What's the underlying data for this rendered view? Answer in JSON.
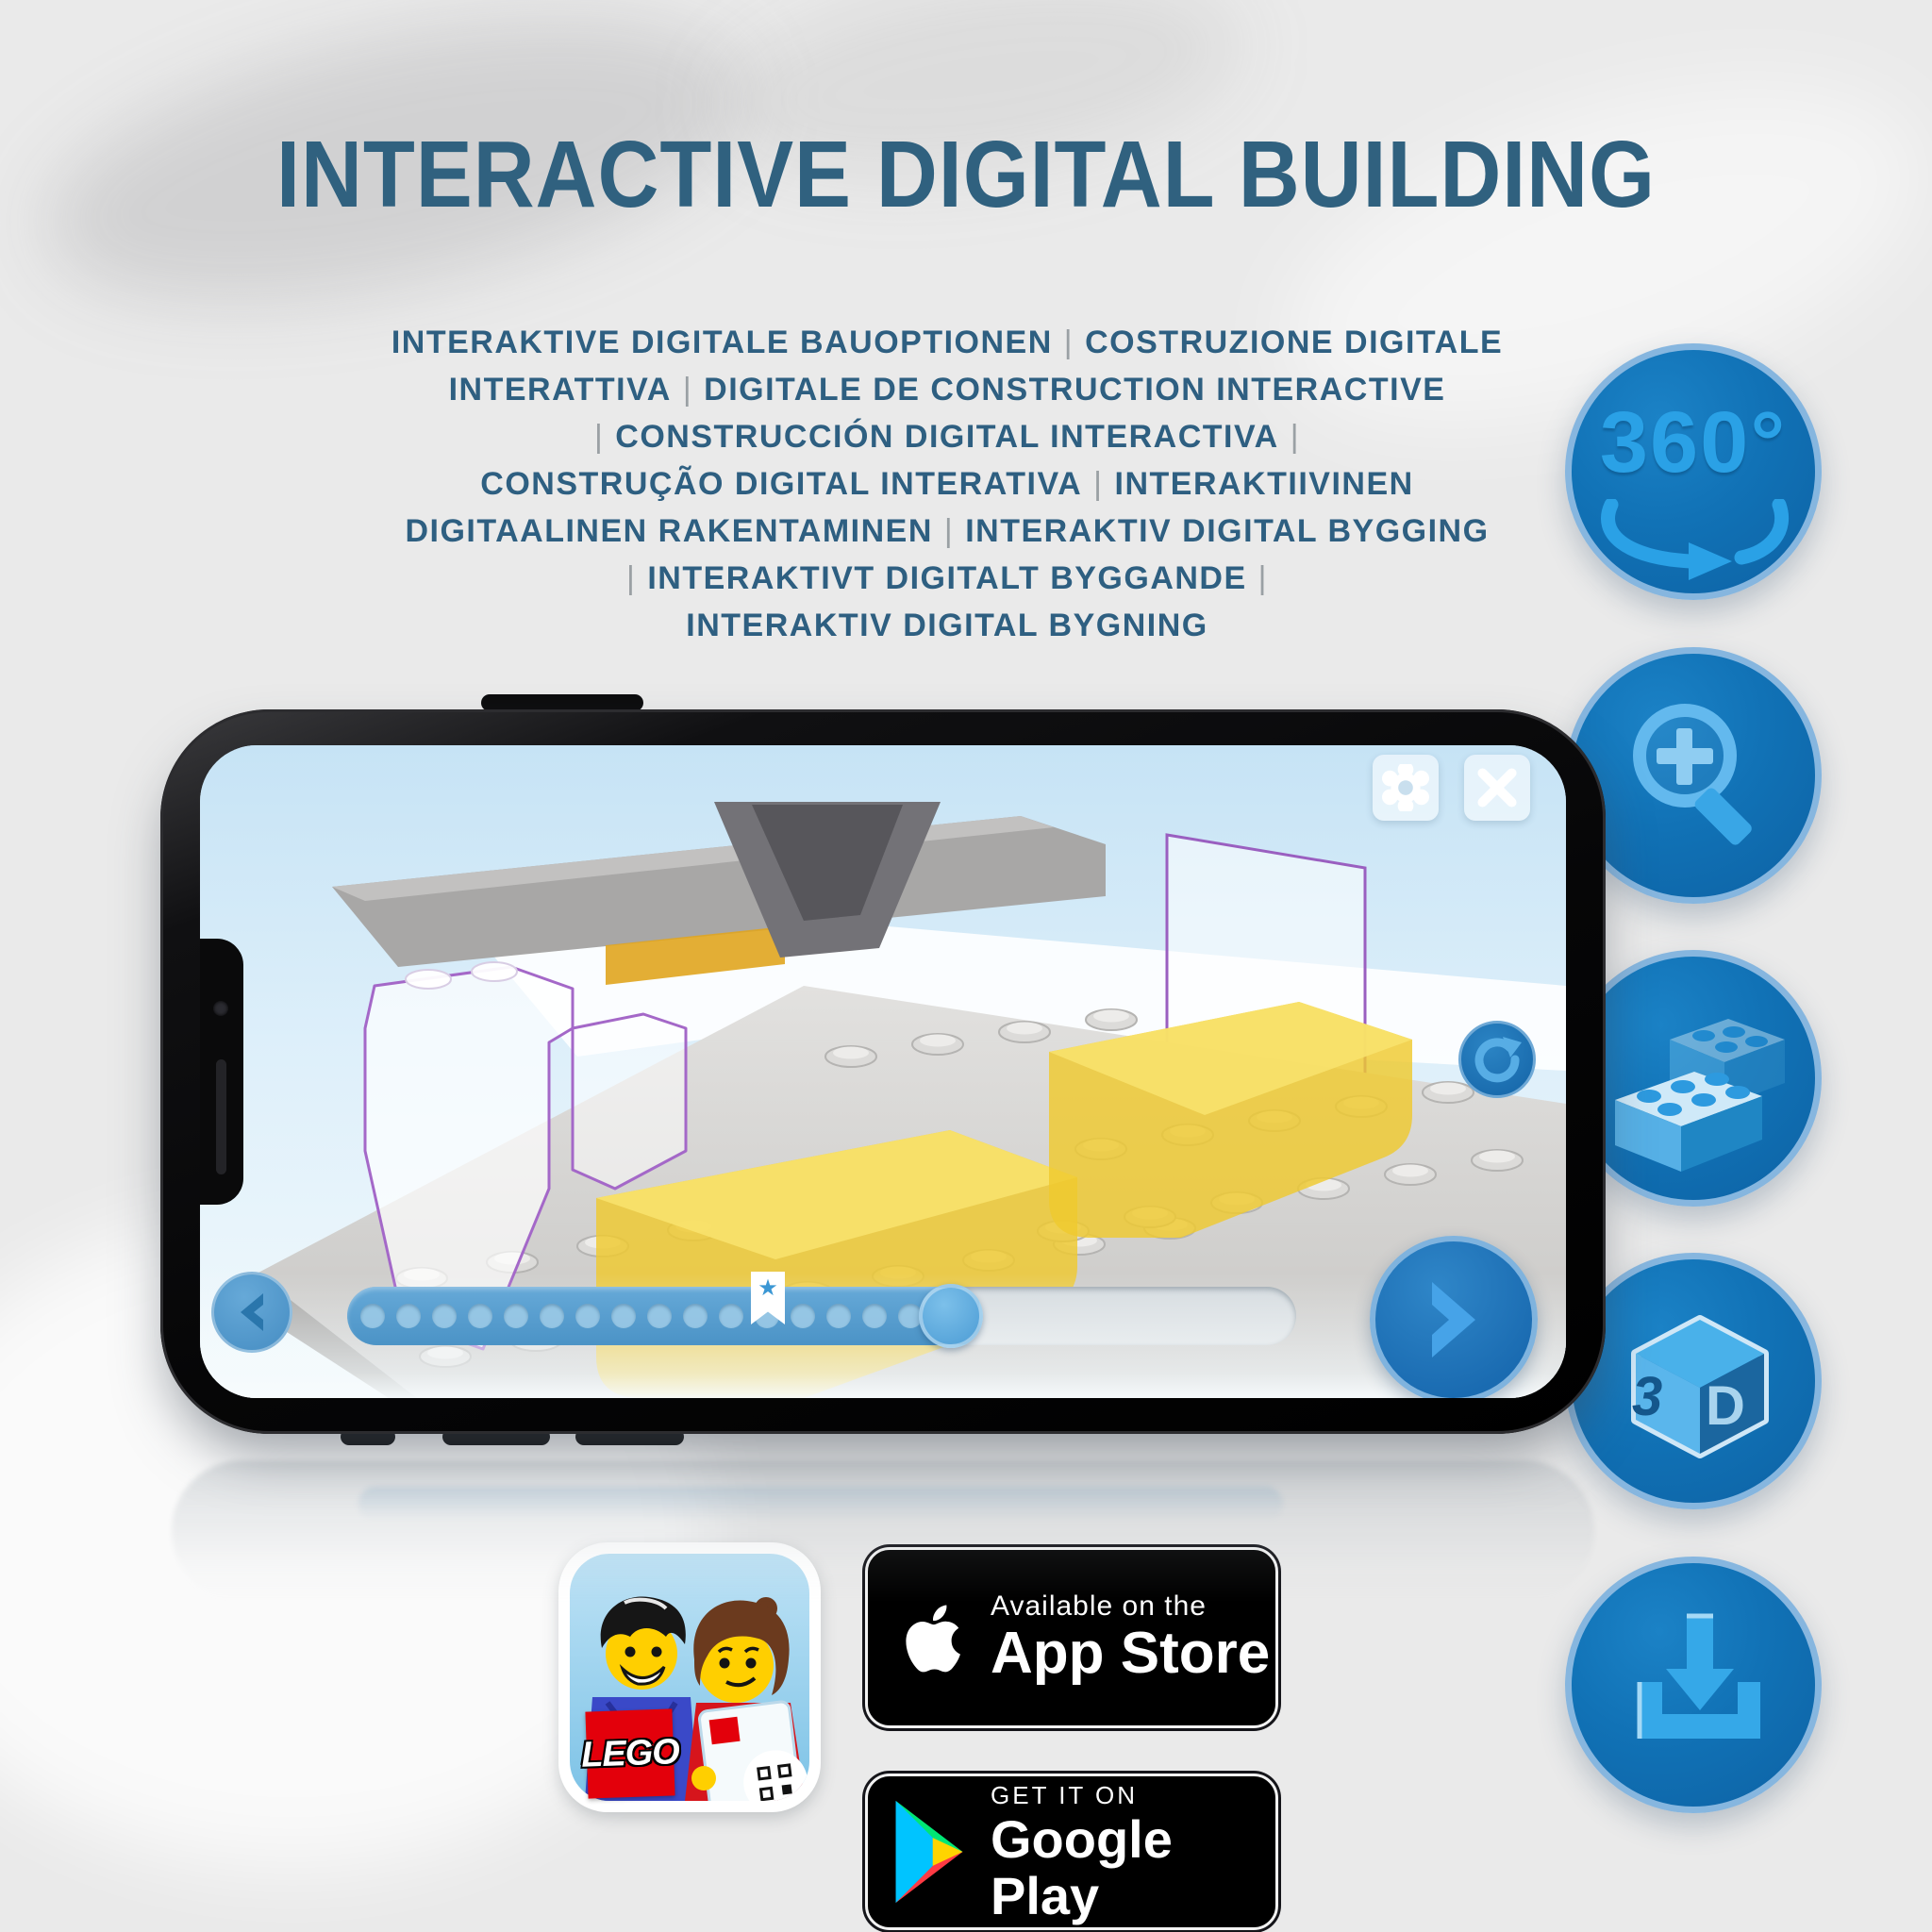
{
  "title": "INTERACTIVE DIGITAL BUILDING",
  "subtitle": {
    "separator": "|",
    "lines": [
      "INTERAKTIVE DIGITALE BAUOPTIONEN | COSTRUZIONE DIGITALE",
      "INTERATTIVA | DIGITALE DE CONSTRUCTION INTERACTIVE",
      "| CONSTRUCCIÓN DIGITAL INTERACTIVA |",
      "CONSTRUÇÃO DIGITAL INTERATIVA | INTERAKTIIVINEN",
      "DIGITAALINEN RAKENTAMINEN | INTERAKTIV DIGITAL BYGGING",
      "| INTERAKTIVT DIGITALT BYGGANDE |",
      "INTERAKTIV DIGITAL BYGNING"
    ]
  },
  "feature_rail": [
    {
      "id": "rotation-360-icon",
      "label": "360°"
    },
    {
      "id": "zoom-in-icon"
    },
    {
      "id": "brick-picker-icon"
    },
    {
      "id": "view-3d-icon",
      "left_face": "3",
      "right_face": "D"
    },
    {
      "id": "download-icon"
    }
  ],
  "phone_app": {
    "controls": [
      {
        "id": "settings-gear"
      },
      {
        "id": "close-x"
      },
      {
        "id": "rotate-view"
      },
      {
        "id": "previous-step"
      },
      {
        "id": "next-step"
      },
      {
        "id": "build-progress-slider"
      },
      {
        "id": "bookmark-star"
      }
    ]
  },
  "store_badges": {
    "lego_app": {
      "logo_text": "LEGO"
    },
    "app_store": {
      "tagline": "Available on the",
      "name": "App Store"
    },
    "google_play": {
      "tagline": "GET IT ON",
      "name": "Google Play"
    }
  },
  "colors": {
    "headline": "#30617f",
    "rail_circle": "#1172b6",
    "rail_glyph": "#2aa1e6",
    "slider_fill": "#4e97c9",
    "badge_bg": "#000000"
  }
}
